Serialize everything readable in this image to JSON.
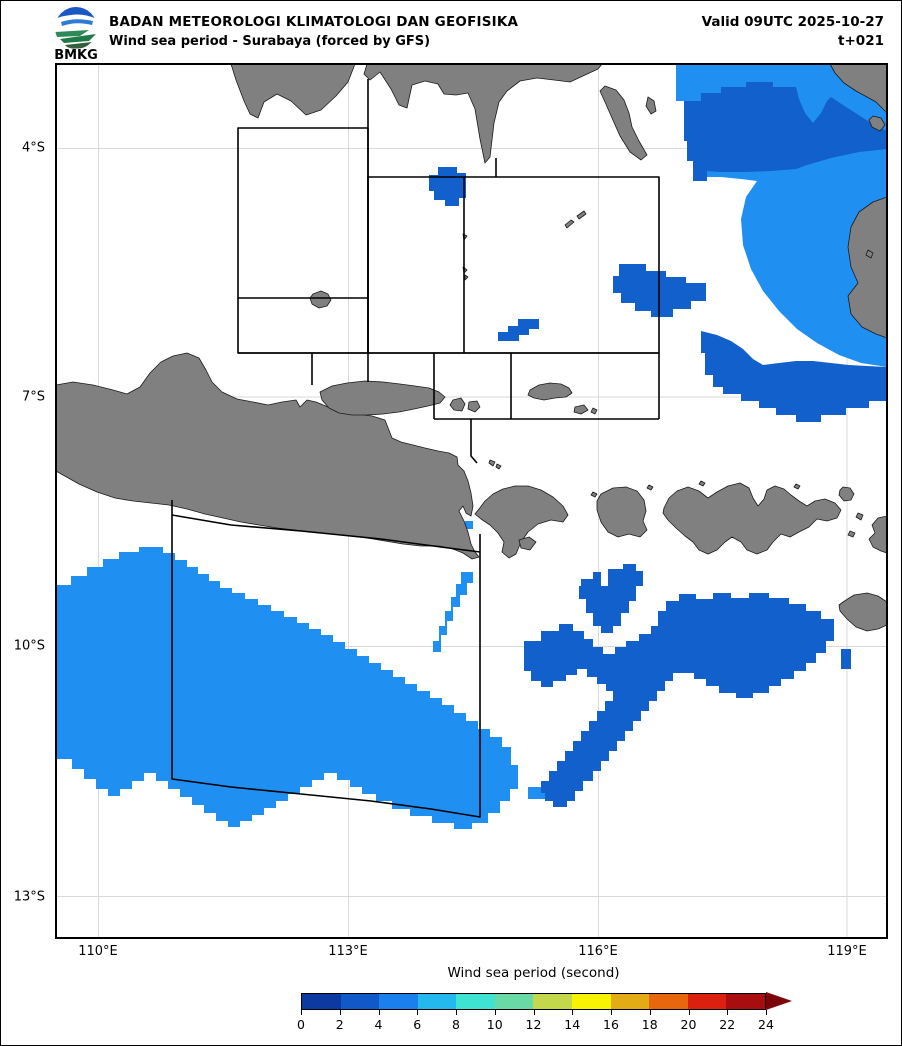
{
  "header": {
    "line1": "BADAN METEOROLOGI KLIMATOLOGI DAN GEOFISIKA",
    "line2": "Wind sea period - Surabaya (forced by GFS)",
    "valid_line1": "Valid 09UTC 2025-10-27",
    "valid_line2": "t+021",
    "logo_label": "BMKG"
  },
  "axes": {
    "lat_labels": [
      "4°S",
      "7°S",
      "10°S",
      "13°S"
    ],
    "lon_labels": [
      "110°E",
      "113°E",
      "116°E",
      "119°E"
    ]
  },
  "colorbar": {
    "title": "Wind sea period (second)",
    "ticks": [
      "0",
      "2",
      "4",
      "6",
      "8",
      "10",
      "12",
      "14",
      "16",
      "18",
      "20",
      "22",
      "24"
    ],
    "colors": [
      "#0c3aa0",
      "#1159c9",
      "#1b7fee",
      "#23b9ef",
      "#3fe3d2",
      "#69daa5",
      "#c3d94b",
      "#f8f303",
      "#e3ab15",
      "#e7660e",
      "#dc2010",
      "#a80d10"
    ],
    "arrow_color": "#7c050a"
  },
  "map_colors": {
    "land": "#808080",
    "coastline": "#1a1a1a",
    "sea": "#ffffff",
    "grid": "#d9d9d9",
    "zone_outline": "#000000",
    "period_2_4s": "#1160cb",
    "period_4_6s": "#1f8ff2"
  }
}
